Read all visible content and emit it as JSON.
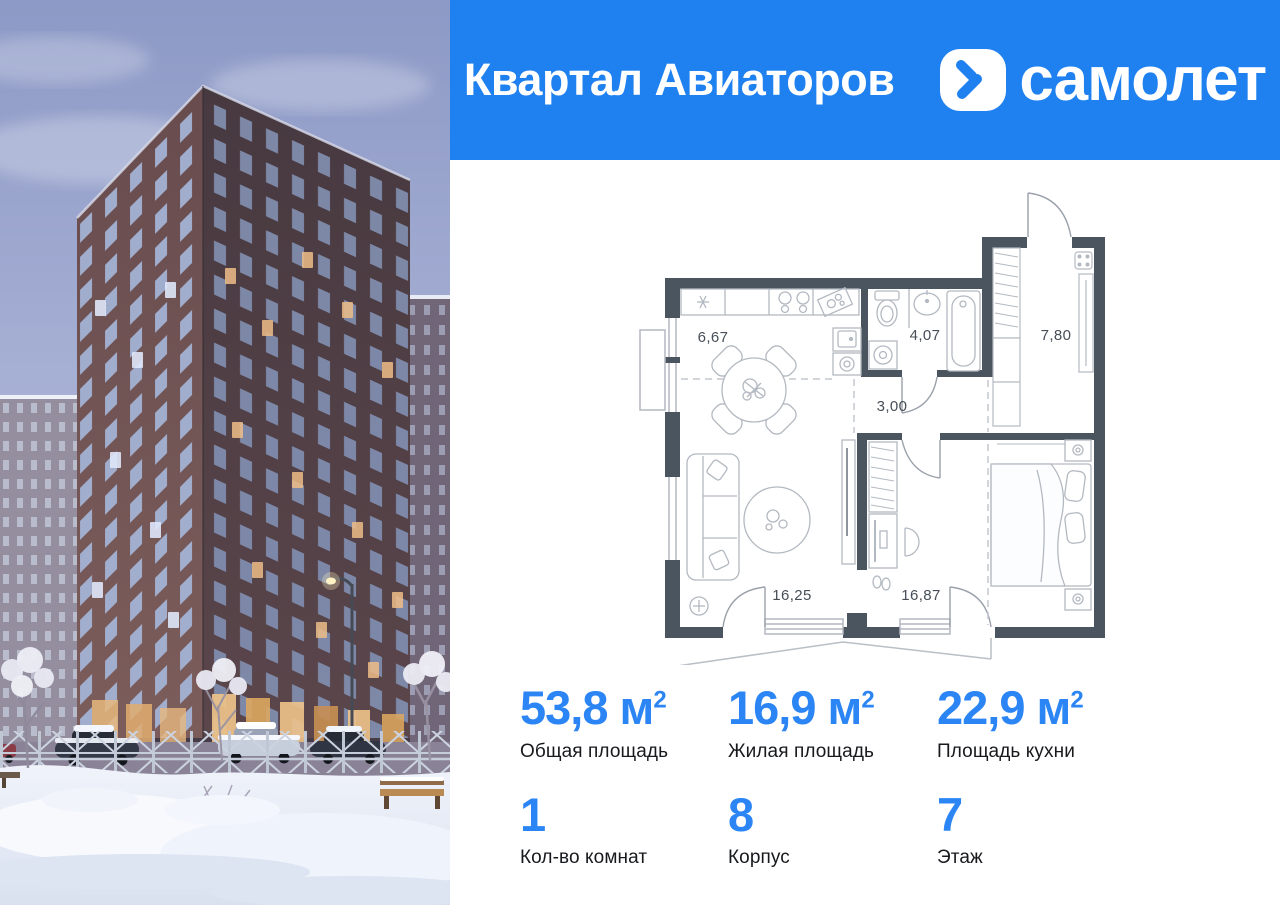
{
  "header": {
    "project_name": "Квартал Авиаторов",
    "brand": "самолет"
  },
  "floor_plan": {
    "rooms": [
      {
        "name": "kitchen-dining",
        "area": "6,67"
      },
      {
        "name": "bathroom",
        "area": "4,07"
      },
      {
        "name": "hallway",
        "area": "7,80"
      },
      {
        "name": "corridor",
        "area": "3,00"
      },
      {
        "name": "living-room",
        "area": "16,25"
      },
      {
        "name": "bedroom",
        "area": "16,87"
      }
    ]
  },
  "stats": {
    "primary": [
      {
        "value": "53,8",
        "unit": "м",
        "sup": "2",
        "label": "Общая площадь"
      },
      {
        "value": "16,9",
        "unit": "м",
        "sup": "2",
        "label": "Жилая площадь"
      },
      {
        "value": "22,9",
        "unit": "м",
        "sup": "2",
        "label": "Площадь кухни"
      }
    ],
    "secondary": [
      {
        "value": "1",
        "label": "Кол-во комнат"
      },
      {
        "value": "8",
        "label": "Корпус"
      },
      {
        "value": "7",
        "label": "Этаж"
      }
    ]
  },
  "colors": {
    "brand_blue": "#1f80f0",
    "stat_value_blue": "#2b85f4",
    "plan_wall": "#4b5560"
  }
}
